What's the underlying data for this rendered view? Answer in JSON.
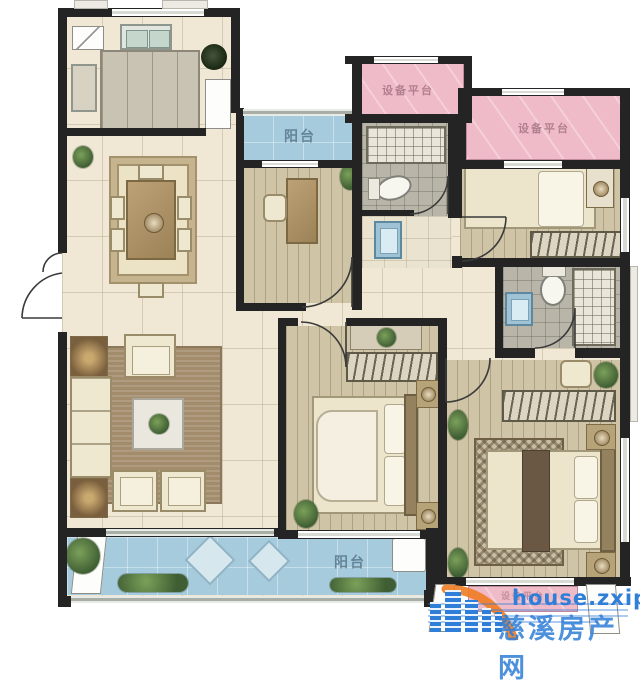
{
  "floorplan": {
    "labels": {
      "balcony_top": "阳台",
      "balcony_bottom": "阳台",
      "equipment_platform_top": "设备平台",
      "equipment_platform_right": "设备平台",
      "equipment_platform_bottom": "设备平台"
    },
    "label_colors": {
      "balcony": "#4e6d80",
      "platform": "#9c6b7a"
    },
    "colors": {
      "wall": "#242424",
      "tile": "#f0e8d4",
      "wood": "#cfc4a5",
      "balcony": "#a5cbdc",
      "platform": "#f0bbc8",
      "bathroom": "#b9b5a9"
    }
  },
  "watermark": {
    "site": "house.zxip.com",
    "name": "慈溪房产网",
    "blue": "#2f7ed8",
    "orange": "#ef7d22"
  }
}
